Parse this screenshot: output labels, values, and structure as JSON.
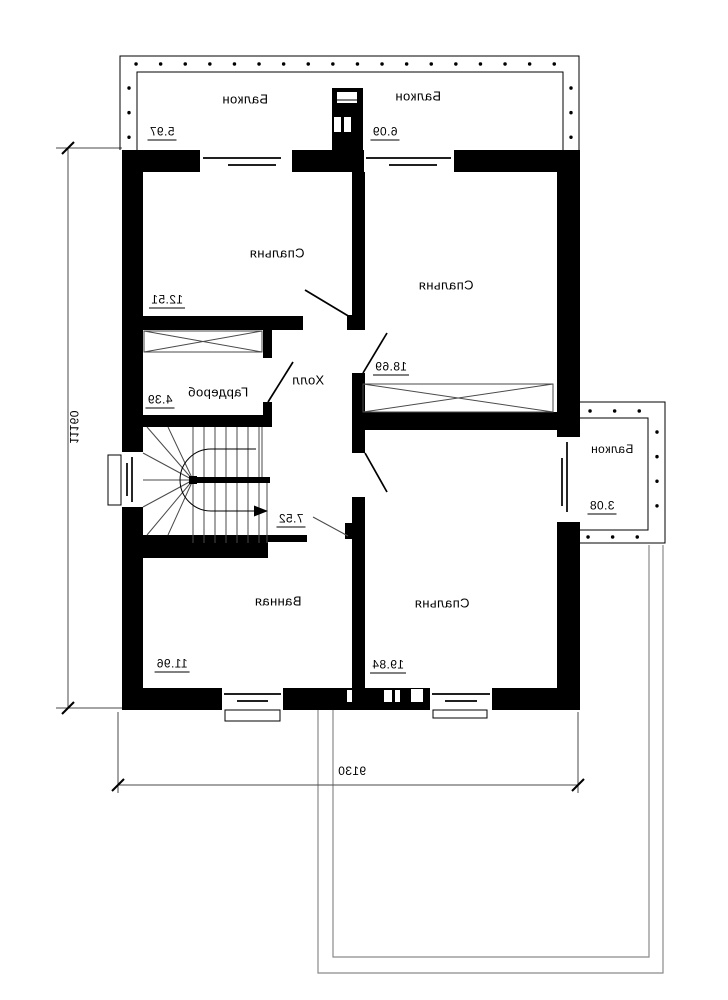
{
  "floorplan": {
    "rooms": {
      "balcony_top_left": {
        "label": "Балкон",
        "area": "5.97"
      },
      "balcony_top_right": {
        "label": "Балкон",
        "area": "6.09"
      },
      "bedroom_top_left": {
        "label": "Спальня",
        "area": "12.51"
      },
      "bedroom_top_right": {
        "label": "Спальня",
        "area": "18.69"
      },
      "wardrobe": {
        "label": "Гардероб",
        "area": "4.39"
      },
      "hall": {
        "label": "Холл",
        "area": "7.52"
      },
      "bathroom": {
        "label": "Ванная",
        "area": "11.96"
      },
      "bedroom_bottom": {
        "label": "Спальня",
        "area": "19.84"
      },
      "balcony_right": {
        "label": "Балкон",
        "area": "3.08"
      }
    },
    "dimensions": {
      "overall_depth": "11160",
      "overall_width": "9130"
    },
    "colors": {
      "wall": "#000000",
      "thin_line": "#4a4a4a",
      "background": "#ffffff"
    }
  }
}
